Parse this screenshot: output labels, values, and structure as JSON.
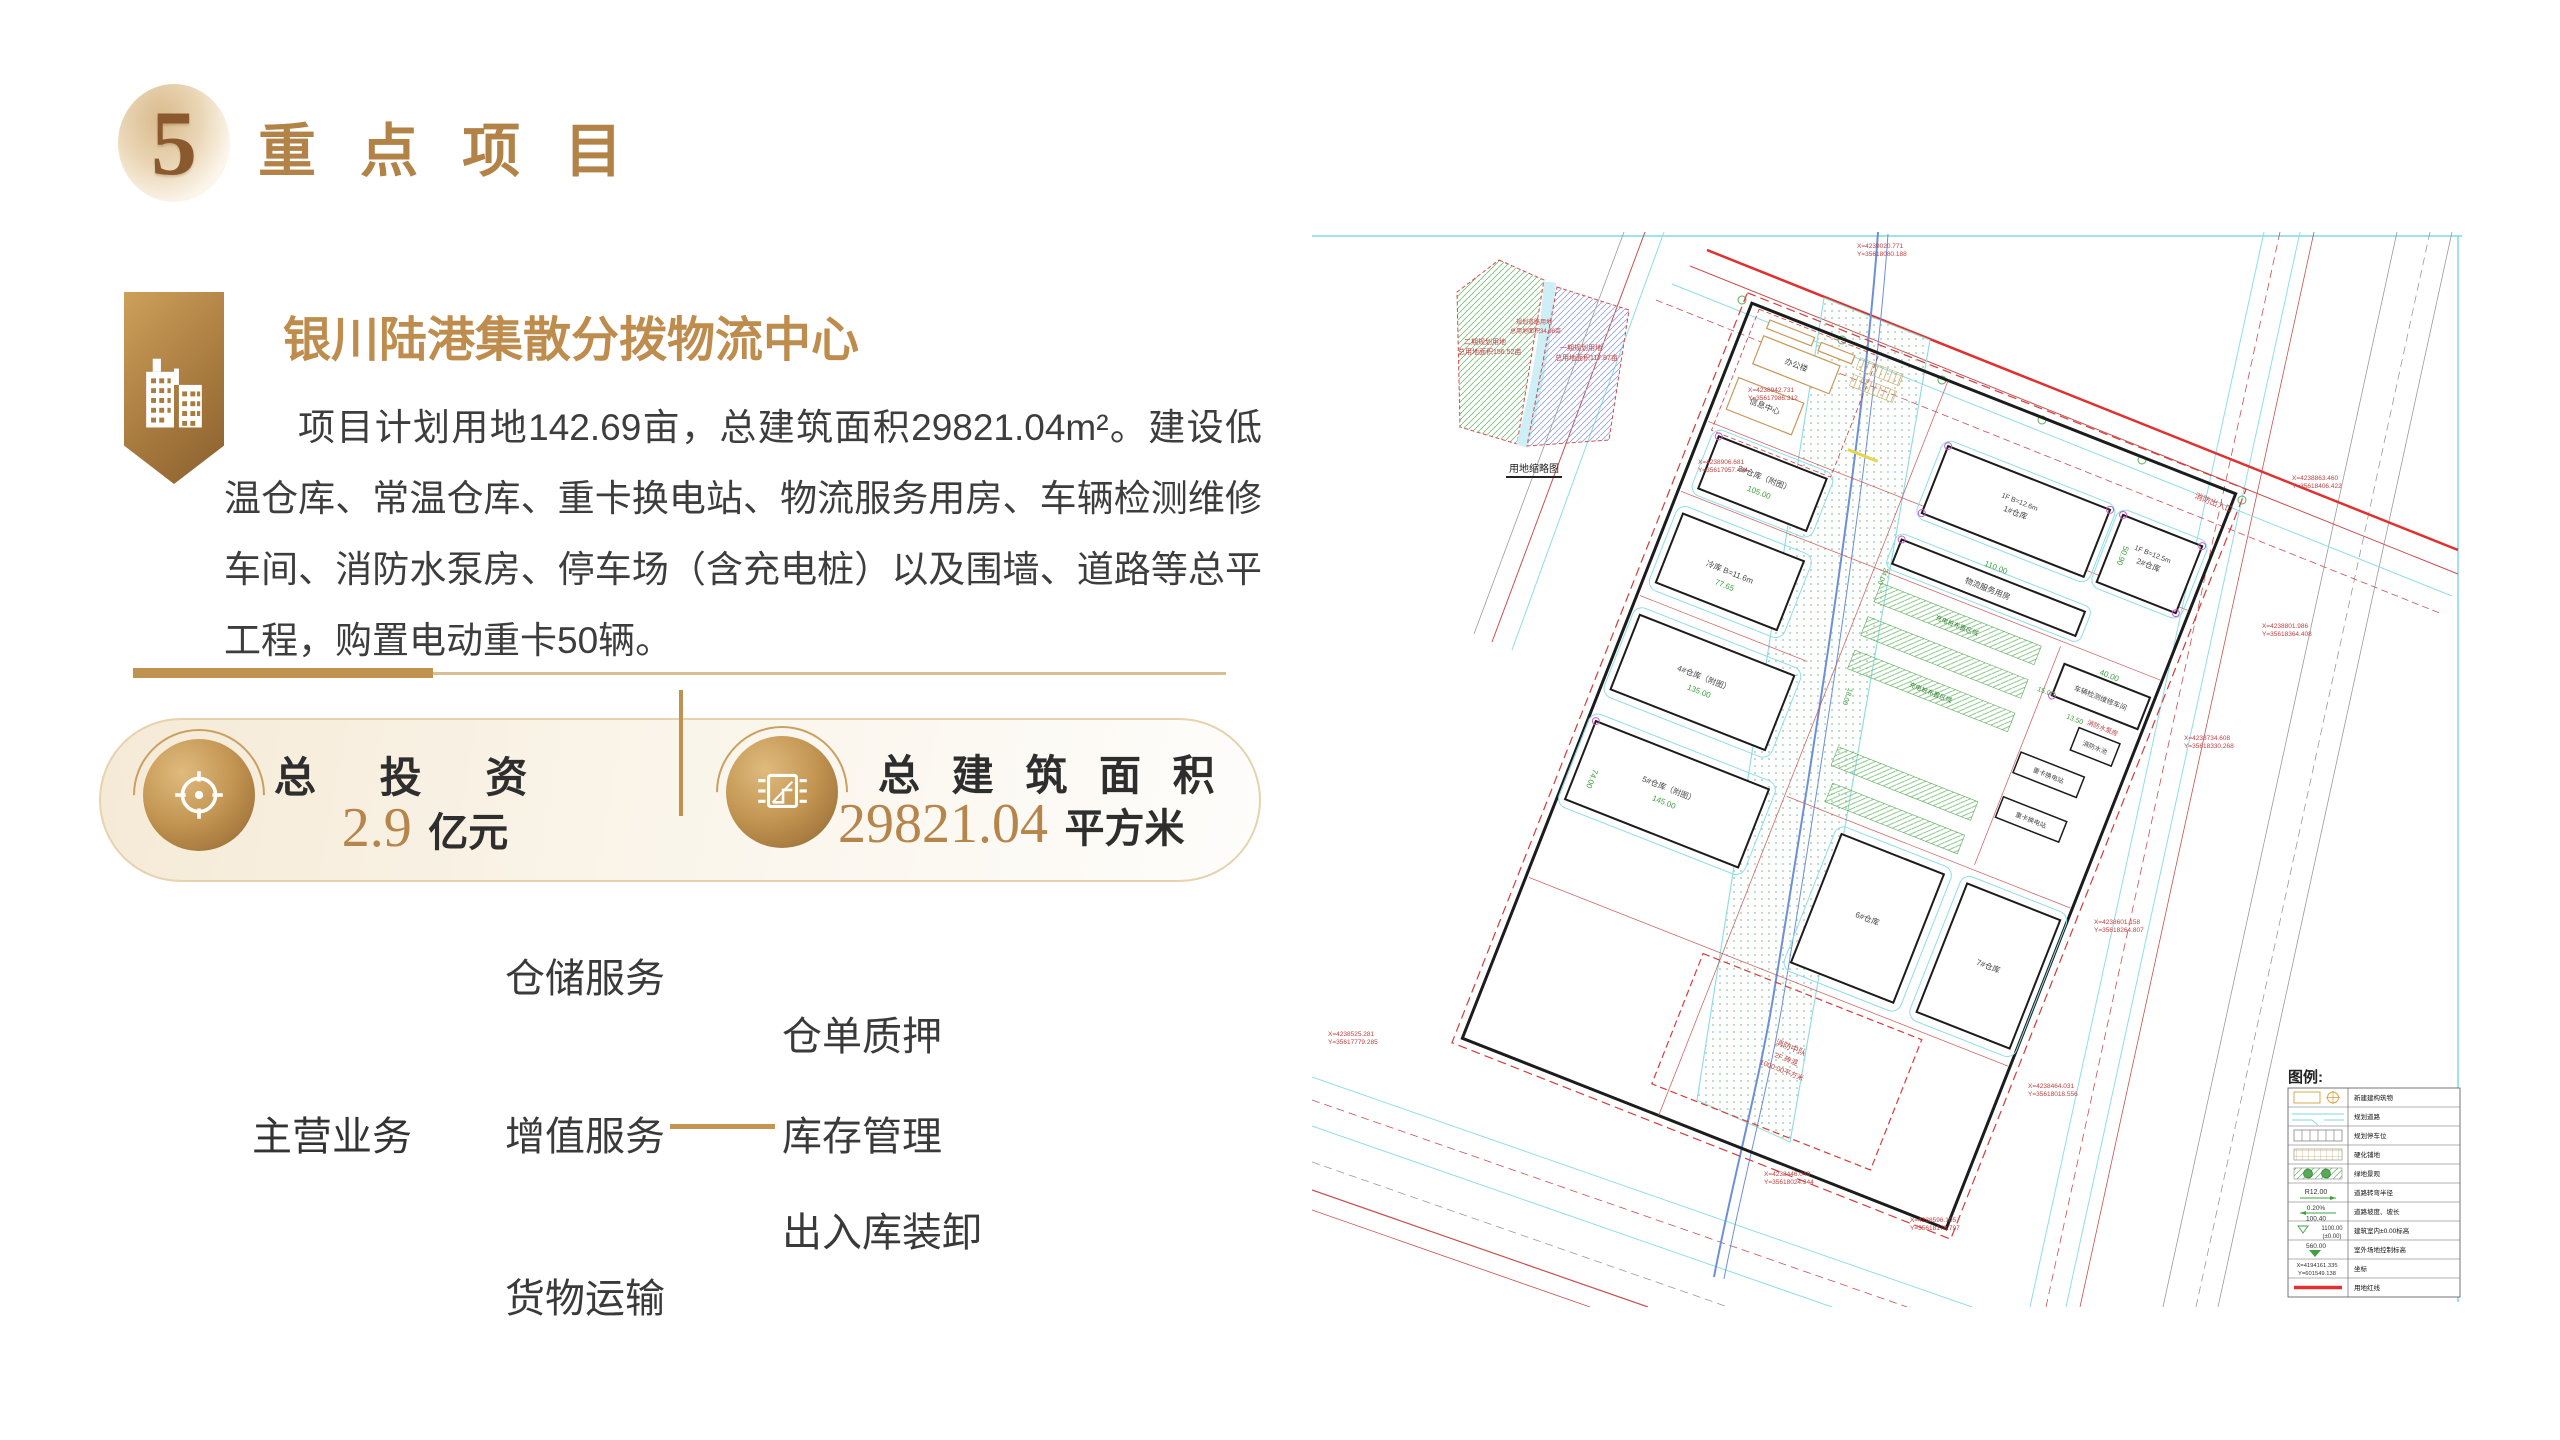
{
  "header": {
    "number": "5",
    "title": "重 点 项 目"
  },
  "project": {
    "title": "银川陆港集散分拨物流中心",
    "description": "项目计划用地142.69亩，总建筑面积29821.04m²。建设低温仓库、常温仓库、重卡换电站、物流服务用房、车辆检测维修车间、消防水泵房、停车场（含充电桩）以及围墙、道路等总平工程，购置电动重卡50辆。"
  },
  "stats": {
    "investment": {
      "label": "总 投 资",
      "value": "2.9",
      "unit": "亿元"
    },
    "area": {
      "label": "总 建 筑 面 积",
      "value": "29821.04",
      "unit": "平方米"
    }
  },
  "business": {
    "root": "主营业务",
    "branches": [
      "仓储服务",
      "增值服务",
      "货物运输"
    ],
    "sub": [
      "仓单质押",
      "库存管理",
      "出入库装卸"
    ]
  },
  "accent": {
    "gold": "#B28247",
    "gold_value": "#B5854B"
  },
  "siteplan": {
    "inset": {
      "parcel_left_name": "二期规划用地",
      "parcel_left_area": "总用地面积156.52亩",
      "parcel_mid_name": "规划道路用地",
      "parcel_mid_area": "总用地面积34.98亩",
      "parcel_right_name": "一期规划用地",
      "parcel_right_area": "总用地面积117.87亩",
      "caption": "用地缩略图"
    },
    "entrances": {
      "fire": "消防出入口"
    },
    "buildings": {
      "office": "办公楼",
      "info_center": "信息中心",
      "wh1_spec": "1F B=12.6m",
      "wh1": "1#仓库",
      "wh2_spec": "1F B=12.5m",
      "wh2": "2#仓库",
      "logistics": "物流服务用房",
      "inspection": "车辆检测维修车间",
      "fire_pool": "消防水池",
      "fire_pump": "消防水泵房",
      "swap_station": "重卡换电站",
      "cold": "冷库 B=11.6m",
      "wh3": "3#仓库（附图）",
      "wh4": "4#仓库（附图）",
      "wh5": "5#仓库（附图）",
      "wh6": "6#仓库",
      "wh7": "7#仓库",
      "fire_squad": "消防中队",
      "fire_squad_spec": "2F 砖混",
      "fire_squad_area": "1000.00平方米",
      "charging_zone": "充电桩布置区域"
    },
    "dims": [
      "50.90",
      "110.00",
      "24.00",
      "40.00",
      "13.50",
      "18.00",
      "15.00",
      "105.00",
      "77.65",
      "135.00",
      "145.00",
      "74.00"
    ],
    "coords": [
      {
        "x": "X=4239020.771",
        "y": "Y=35618080.188"
      },
      {
        "x": "X=4238863.460",
        "y": "Y=35618406.422"
      },
      {
        "x": "X=4238801.986",
        "y": "Y=35618364.408"
      },
      {
        "x": "X=4238734.608",
        "y": "Y=35618330.268"
      },
      {
        "x": "X=4238601.158",
        "y": "Y=35618264.807"
      },
      {
        "x": "X=4238464.031",
        "y": "Y=35618018.556"
      },
      {
        "x": "X=4238596.105",
        "y": "Y=35618178.797"
      },
      {
        "x": "X=4238446.049",
        "y": "Y=35618024.344"
      },
      {
        "x": "X=4238525.281",
        "y": "Y=35617779.285"
      },
      {
        "x": "X=4238906.681",
        "y": "Y=35617957.434"
      },
      {
        "x": "X=4238942.731",
        "y": "Y=35617986.312"
      }
    ],
    "legend": {
      "title": "图例:",
      "rows": [
        {
          "label": "新建建构筑物"
        },
        {
          "label": "规划道路"
        },
        {
          "label": "规划停车位"
        },
        {
          "label": "硬化铺地"
        },
        {
          "label": "绿地景观"
        },
        {
          "sym": "R12.00",
          "label": "道路转弯半径"
        },
        {
          "sym": "0.20%",
          "sym2": "100.40",
          "label": "道路坡度、坡长"
        },
        {
          "sym": "1100.00",
          "sym2": "(±0.00)",
          "label": "建筑室内±0.00标高"
        },
        {
          "sym": "560.00",
          "label": "室外场地控制标高"
        },
        {
          "sym": "X=4194161.335",
          "sym2": "Y=601549.138",
          "label": "坐标"
        },
        {
          "label": "用地红线"
        }
      ]
    }
  }
}
